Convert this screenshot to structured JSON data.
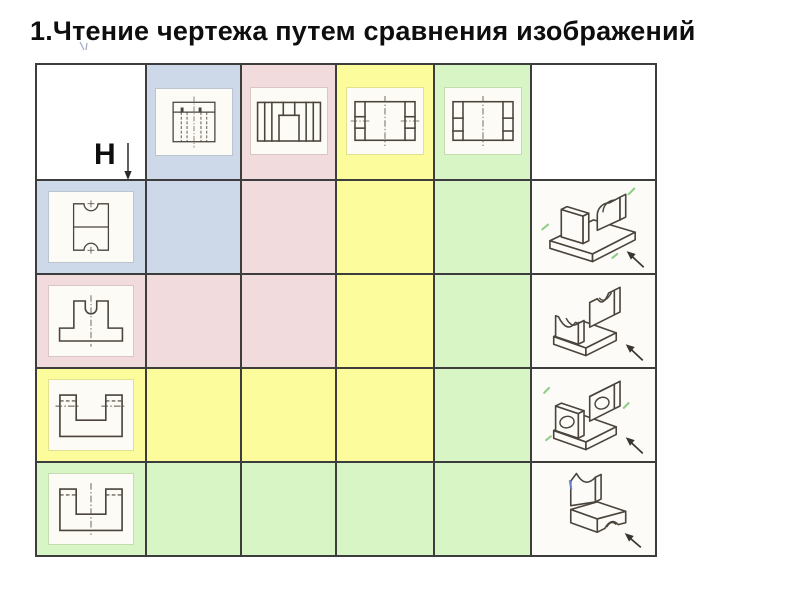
{
  "title": "1.Чтение чертежа путем сравнения изображений",
  "corner": {
    "h_label": "H",
    "v_label": "V"
  },
  "palette": {
    "blue": "#cdd8e8",
    "pink": "#f2dbdc",
    "yellow": "#fcfc9c",
    "green": "#d8f5c6",
    "grid": "#3d3d3d",
    "sketch": "#4a443c",
    "centerline": "#5a544c",
    "inset": "#fcfbf5",
    "paper": "#fcfbf7",
    "check": "#7cc473",
    "bluemark": "#6b7fd6"
  },
  "header": {
    "top_views": [
      {
        "id": "top-view-1",
        "bg": "blue"
      },
      {
        "id": "top-view-2",
        "bg": "pink"
      },
      {
        "id": "top-view-3",
        "bg": "yellow"
      },
      {
        "id": "top-view-4",
        "bg": "green"
      }
    ]
  },
  "rows": [
    {
      "front_view": "front-view-1",
      "bg": "blue",
      "isometric": "isometric-1"
    },
    {
      "front_view": "front-view-2",
      "bg": "pink",
      "isometric": "isometric-2"
    },
    {
      "front_view": "front-view-3",
      "bg": "yellow",
      "isometric": "isometric-3"
    },
    {
      "front_view": "front-view-4",
      "bg": "green",
      "isometric": "isometric-4"
    }
  ]
}
